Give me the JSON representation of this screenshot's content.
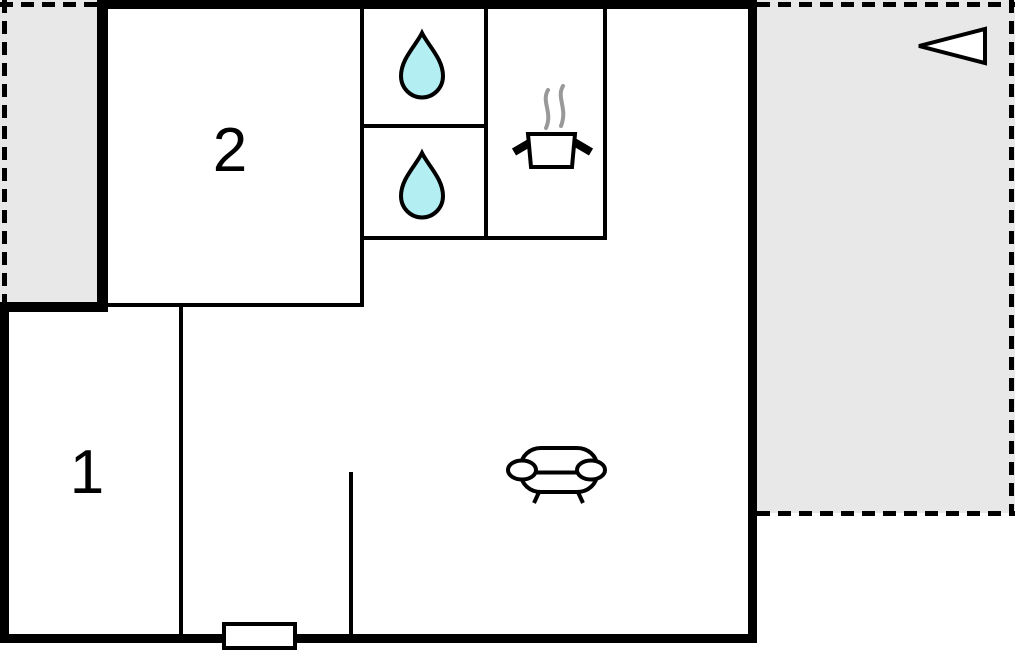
{
  "plan": {
    "type": "floor-plan",
    "rooms": {
      "room1": {
        "label": "1"
      },
      "room2": {
        "label": "2"
      }
    },
    "fixtures": {
      "bathroom": [
        "water-drop-icon",
        "water-drop-icon"
      ],
      "kitchen": "cooking-pot-icon",
      "living_room": "sofa-icon",
      "entrance": "door-marker",
      "orientation": "direction-arrow-icon",
      "terraces": [
        "terrace-left",
        "terrace-right"
      ]
    },
    "colors": {
      "wall": "#000000",
      "terrace_fill": "#e8e8e8",
      "water_drop_fill": "#b3eef2",
      "steam": "#999999",
      "icon_fill": "#ffffff",
      "background": "#ffffff"
    }
  }
}
